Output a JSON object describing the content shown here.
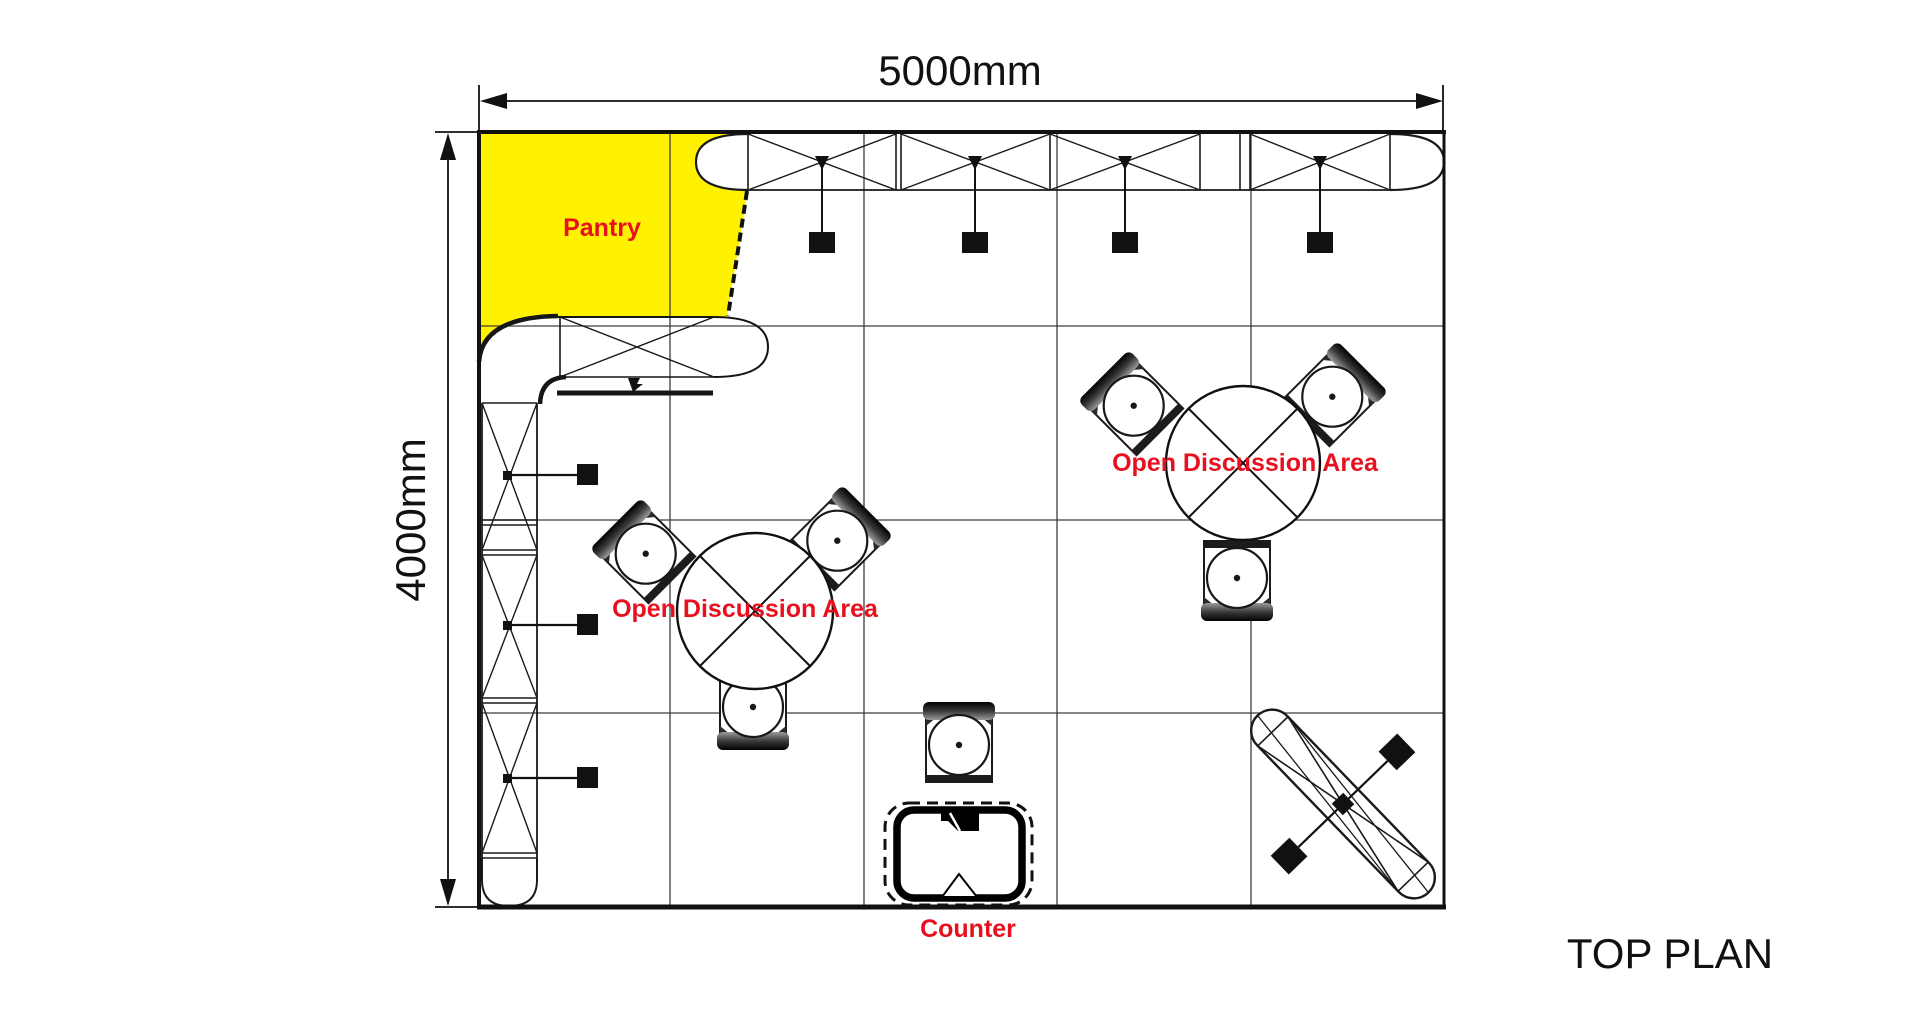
{
  "drawing": {
    "title": "TOP PLAN",
    "dimensions": {
      "width_label": "5000mm",
      "height_label": "4000mm"
    },
    "labels": {
      "pantry": "Pantry",
      "discussion_area_1": "Open Discussion Area",
      "discussion_area_2": "Open Discussion Area",
      "counter": "Counter"
    },
    "colors": {
      "pantry_fill": "#FFF200",
      "label_red": "#E8101E",
      "line": "#1A1A1A"
    },
    "grid": {
      "columns": 5,
      "rows": 4,
      "cell_mm": 1000
    },
    "furniture": {
      "round_tables": 2,
      "chairs_per_table": 3,
      "standalone_chairs": 1,
      "hanging_lights_top_truss": 4,
      "lights_left_truss": 3
    }
  }
}
